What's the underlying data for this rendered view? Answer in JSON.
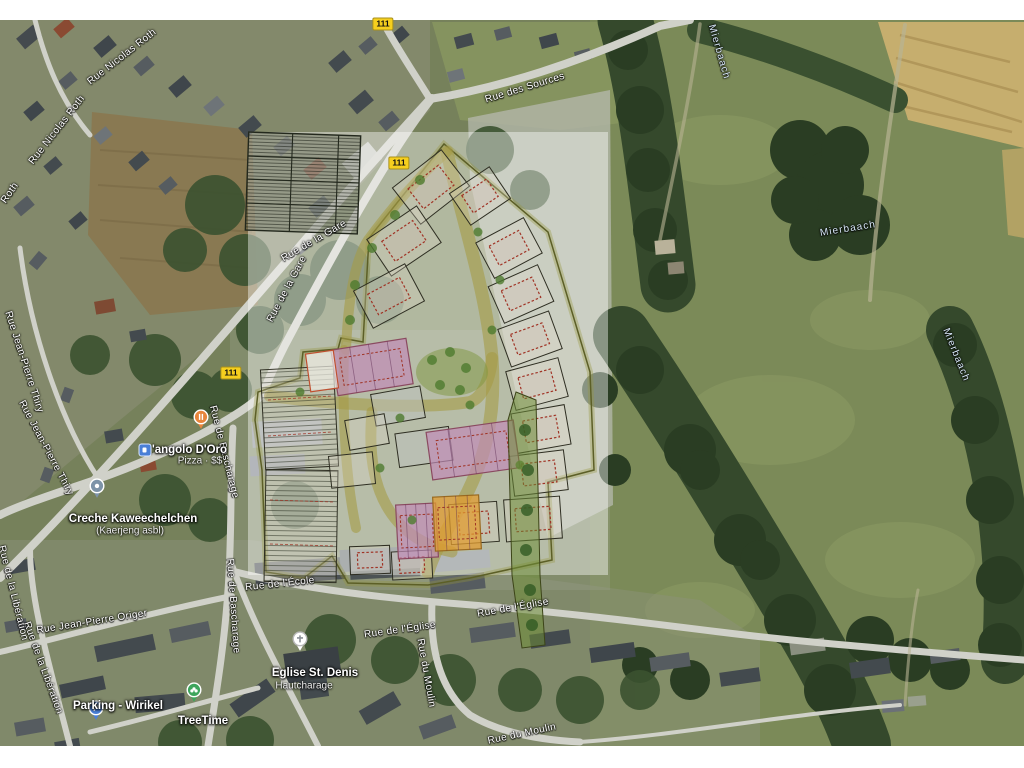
{
  "map": {
    "type": "satellite-map-with-siteplan-overlay",
    "route_badges": [
      {
        "label": "111"
      },
      {
        "label": "111"
      },
      {
        "label": "111"
      }
    ],
    "street_labels": [
      {
        "text": "Rue Nicolas Roth"
      },
      {
        "text": "Rue Nicolas Roth"
      },
      {
        "text": "Roth"
      },
      {
        "text": "Rue des Sources"
      },
      {
        "text": "Rue de la Gare"
      },
      {
        "text": "Rue de la Gare"
      },
      {
        "text": "Rue de Bascharage"
      },
      {
        "text": "Rue de Bascharage"
      },
      {
        "text": "Rue Jean-Pierre Thiry"
      },
      {
        "text": "Rue Jean-Pierre Thiry"
      },
      {
        "text": "Rue de la Libération"
      },
      {
        "text": "Rue de la Libération"
      },
      {
        "text": "Rue Jean-Pierre Origer"
      },
      {
        "text": "Rue de l'École"
      },
      {
        "text": "Rue de l'Église"
      },
      {
        "text": "Rue de l'Église"
      },
      {
        "text": "Rue du Moulin"
      },
      {
        "text": "Rue du Moulin"
      }
    ],
    "water_labels": [
      {
        "text": "Mierbaach"
      },
      {
        "text": "Mierbaach"
      },
      {
        "text": "Mierbaach"
      }
    ],
    "pois": [
      {
        "id": "pizza",
        "title": "L'angolo D'Oro",
        "subtitle": "Pizza · $$",
        "marker": "restaurant-icon",
        "color": "#e8853c"
      },
      {
        "id": "creche",
        "title": "Creche Kaweechelchen",
        "subtitle": "(Kaerjeng asbl)",
        "marker": "school-icon",
        "color": "#7d93a8"
      },
      {
        "id": "parking",
        "title": "Parking - Wirikel",
        "subtitle": "",
        "marker": "parking-icon",
        "color": "#4a7fd6"
      },
      {
        "id": "treetime",
        "title": "TreeTime",
        "subtitle": "",
        "marker": "tree-icon",
        "color": "#3da55c"
      },
      {
        "id": "church",
        "title": "Eglise St. Denis",
        "subtitle": "Hautcharage",
        "marker": "church-icon",
        "color": "#ffffff"
      }
    ],
    "transit_icon": "bus-stop-icon",
    "overlay": {
      "description": "semi-transparent development site plan overlay with lot boundaries, planned buildings and allotment grid"
    }
  },
  "colors": {
    "route_badge": "#f6cf1e",
    "plan_lot_outline": "#2e2e22",
    "plan_building_outline": "#a03325",
    "plan_rowhouse_purple": "#c18cb6",
    "plan_rowhouse_orange": "#e29c30",
    "plan_road_olive": "#a59b46",
    "plan_greenery": "#6f9a3c",
    "overlay_white": "#ffffff"
  }
}
